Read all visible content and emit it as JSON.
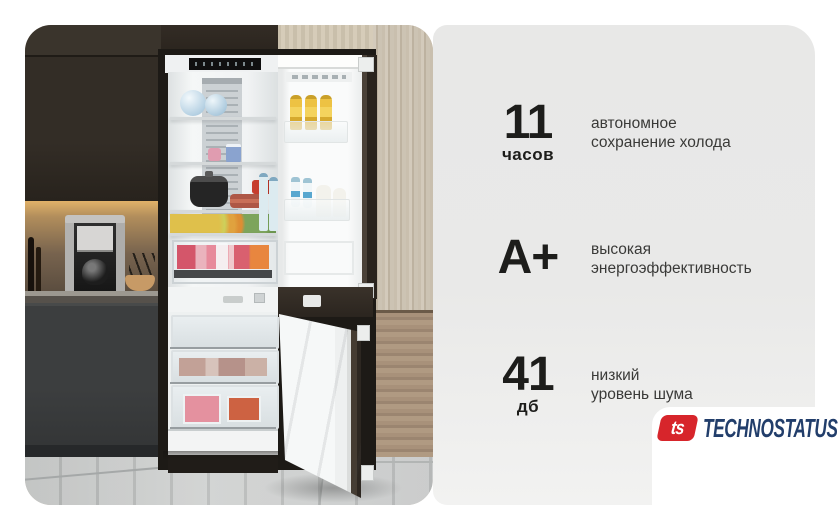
{
  "card": {
    "background": "#ffffff"
  },
  "photo": {
    "alt": "встроенный холодильник с открытыми дверцами на кухне",
    "palette": {
      "upper_cabinet": "#2e2822",
      "under_cabinet_light": "#e2b269",
      "backsplash": "#77634e",
      "base_cabinet": "#3c3e3f",
      "wood_panel_light": "#c9bfae",
      "wood_panel_warm": "#a8917a",
      "floor_tile": "#c5c7c6",
      "fridge_interior": "#f1f3f4",
      "fridge_door": "#fafbfb"
    }
  },
  "specs_panel": {
    "background": "#e9e9e8",
    "value_color": "#1d1d1b",
    "label_color": "#3a3a38",
    "items": [
      {
        "value": "11",
        "unit": "часов",
        "label": "автономное\nсохранение холода"
      },
      {
        "value": "A+",
        "unit": "",
        "label": "высокая\nэнергоэффективность"
      },
      {
        "value": "41",
        "unit": "дб",
        "label": "низкий\nуровень шума"
      }
    ]
  },
  "logo": {
    "monogram": "ts",
    "brand": "TECHNOSTATUS",
    "red": "#d7252b",
    "navy": "#223e6b"
  }
}
